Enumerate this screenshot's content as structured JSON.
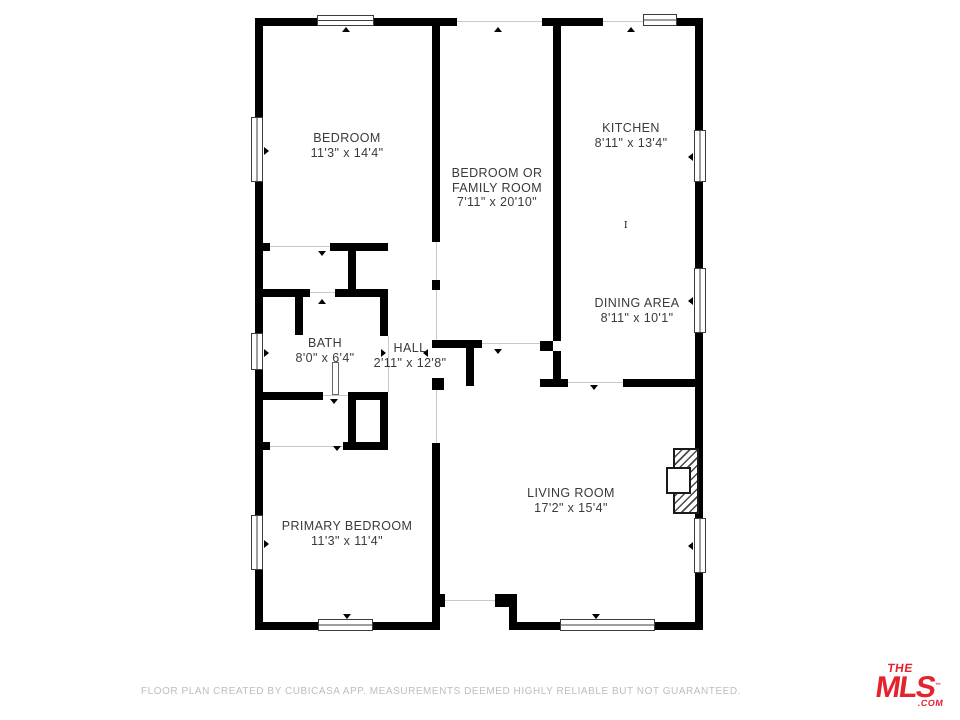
{
  "floorplan": {
    "wall_color": "#000000",
    "label_color": "#3a3a3a",
    "opening_line_color": "#c9c9c9",
    "window_border_color": "#3c3c3c",
    "walls": [
      [
        255,
        18,
        62,
        8
      ],
      [
        374,
        18,
        83,
        8
      ],
      [
        542,
        18,
        61,
        8
      ],
      [
        677,
        18,
        26,
        8
      ],
      [
        255,
        26,
        8,
        91
      ],
      [
        255,
        182,
        8,
        151
      ],
      [
        255,
        370,
        8,
        145
      ],
      [
        255,
        570,
        8,
        52
      ],
      [
        255,
        622,
        63,
        8
      ],
      [
        373,
        622,
        67,
        8
      ],
      [
        509,
        622,
        51,
        8
      ],
      [
        655,
        622,
        48,
        8
      ],
      [
        695,
        26,
        8,
        104
      ],
      [
        695,
        182,
        8,
        86
      ],
      [
        695,
        333,
        8,
        185
      ],
      [
        695,
        573,
        8,
        49
      ],
      [
        432,
        594,
        13,
        13
      ],
      [
        495,
        594,
        22,
        13
      ],
      [
        509,
        607,
        8,
        15
      ],
      [
        432,
        26,
        8,
        216
      ],
      [
        432,
        280,
        8,
        10
      ],
      [
        432,
        443,
        8,
        179
      ],
      [
        432,
        340,
        50,
        8
      ],
      [
        466,
        348,
        8,
        38
      ],
      [
        432,
        378,
        12,
        12
      ],
      [
        553,
        26,
        8,
        315
      ],
      [
        540,
        341,
        13,
        10
      ],
      [
        553,
        351,
        8,
        36
      ],
      [
        540,
        379,
        28,
        8
      ],
      [
        623,
        379,
        80,
        8
      ],
      [
        255,
        243,
        15,
        8
      ],
      [
        330,
        243,
        58,
        8
      ],
      [
        348,
        251,
        8,
        46
      ],
      [
        255,
        289,
        55,
        8
      ],
      [
        335,
        289,
        53,
        8
      ],
      [
        295,
        297,
        8,
        38
      ],
      [
        380,
        289,
        8,
        47
      ],
      [
        255,
        392,
        68,
        8
      ],
      [
        348,
        392,
        40,
        8
      ],
      [
        348,
        400,
        8,
        47
      ],
      [
        380,
        392,
        8,
        58
      ],
      [
        255,
        442,
        15,
        8
      ],
      [
        343,
        442,
        45,
        8
      ]
    ],
    "openings": [
      [
        457,
        21,
        85,
        1
      ],
      [
        603,
        21,
        40,
        1
      ],
      [
        445,
        600,
        50,
        1
      ],
      [
        270,
        246,
        60,
        1
      ],
      [
        482,
        343,
        58,
        1
      ],
      [
        568,
        382,
        55,
        1
      ],
      [
        436,
        242,
        1,
        38
      ],
      [
        436,
        290,
        1,
        50
      ],
      [
        436,
        390,
        1,
        53
      ],
      [
        270,
        446,
        73,
        1
      ],
      [
        323,
        395,
        25,
        1
      ],
      [
        310,
        292,
        25,
        1
      ],
      [
        388,
        336,
        1,
        56
      ]
    ],
    "windows": [
      {
        "x": 317,
        "y": 15,
        "w": 57,
        "h": 11,
        "o": "h"
      },
      {
        "x": 643,
        "y": 14,
        "w": 34,
        "h": 12,
        "o": "h"
      },
      {
        "x": 251,
        "y": 117,
        "w": 12,
        "h": 65,
        "o": "v"
      },
      {
        "x": 251,
        "y": 333,
        "w": 12,
        "h": 37,
        "o": "v"
      },
      {
        "x": 251,
        "y": 515,
        "w": 12,
        "h": 55,
        "o": "v"
      },
      {
        "x": 318,
        "y": 619,
        "w": 55,
        "h": 12,
        "o": "h"
      },
      {
        "x": 560,
        "y": 619,
        "w": 95,
        "h": 12,
        "o": "h"
      },
      {
        "x": 694,
        "y": 130,
        "w": 12,
        "h": 52,
        "o": "v"
      },
      {
        "x": 694,
        "y": 268,
        "w": 12,
        "h": 65,
        "o": "v"
      },
      {
        "x": 694,
        "y": 518,
        "w": 12,
        "h": 55,
        "o": "v"
      }
    ],
    "ticks": [
      {
        "x": 342,
        "y": 27,
        "d": "u"
      },
      {
        "x": 494,
        "y": 27,
        "d": "u"
      },
      {
        "x": 627,
        "y": 27,
        "d": "u"
      },
      {
        "x": 318,
        "y": 251,
        "d": "d"
      },
      {
        "x": 318,
        "y": 299,
        "d": "u"
      },
      {
        "x": 330,
        "y": 399,
        "d": "d"
      },
      {
        "x": 494,
        "y": 349,
        "d": "d"
      },
      {
        "x": 590,
        "y": 385,
        "d": "d"
      },
      {
        "x": 343,
        "y": 614,
        "d": "d"
      },
      {
        "x": 592,
        "y": 614,
        "d": "d"
      },
      {
        "x": 264,
        "y": 147,
        "d": "r"
      },
      {
        "x": 264,
        "y": 349,
        "d": "r"
      },
      {
        "x": 264,
        "y": 540,
        "d": "r"
      },
      {
        "x": 688,
        "y": 153,
        "d": "l"
      },
      {
        "x": 688,
        "y": 297,
        "d": "l"
      },
      {
        "x": 688,
        "y": 542,
        "d": "l"
      },
      {
        "x": 381,
        "y": 349,
        "d": "r"
      },
      {
        "x": 423,
        "y": 349,
        "d": "l"
      },
      {
        "x": 333,
        "y": 446,
        "d": "d"
      }
    ],
    "door_leaf": {
      "x": 332,
      "y": 362,
      "w": 7,
      "h": 33
    },
    "section_marker": {
      "x": 624,
      "y": 222,
      "glyph": "I"
    },
    "fireplace": {
      "hatch": {
        "x": 673,
        "y": 448,
        "w": 26,
        "h": 66
      },
      "firebox": {
        "x": 666,
        "y": 467,
        "w": 25,
        "h": 27
      }
    },
    "rooms": [
      {
        "id": "bedroom",
        "lines": [
          "BEDROOM",
          "11'3\" x 14'4\""
        ],
        "cx": 347,
        "top": 131
      },
      {
        "id": "bedroom-or-family-room",
        "lines": [
          "BEDROOM OR",
          "FAMILY ROOM",
          "7'11\" x 20'10\""
        ],
        "cx": 497,
        "top": 166
      },
      {
        "id": "kitchen",
        "lines": [
          "KITCHEN",
          "8'11\" x 13'4\""
        ],
        "cx": 631,
        "top": 121
      },
      {
        "id": "dining-area",
        "lines": [
          "DINING AREA",
          "8'11\" x 10'1\""
        ],
        "cx": 637,
        "top": 296
      },
      {
        "id": "bath",
        "lines": [
          "BATH",
          "8'0\" x 6'4\""
        ],
        "cx": 325,
        "top": 336
      },
      {
        "id": "hall",
        "lines": [
          "HALL",
          "2'11\" x 12'8\""
        ],
        "cx": 410,
        "top": 341
      },
      {
        "id": "primary-bedroom",
        "lines": [
          "PRIMARY BEDROOM",
          "11'3\" x 11'4\""
        ],
        "cx": 347,
        "top": 519
      },
      {
        "id": "living-room",
        "lines": [
          "LIVING ROOM",
          "17'2\" x 15'4\""
        ],
        "cx": 571,
        "top": 486
      }
    ]
  },
  "footer": {
    "disclaimer": "FLOOR PLAN CREATED BY CUBICASA APP. MEASUREMENTS DEEMED HIGHLY RELIABLE BUT NOT GUARANTEED."
  },
  "logo": {
    "the": "THE",
    "mls": "MLS",
    "tm": "™",
    "com": ".COM",
    "color": "#e3242f"
  }
}
